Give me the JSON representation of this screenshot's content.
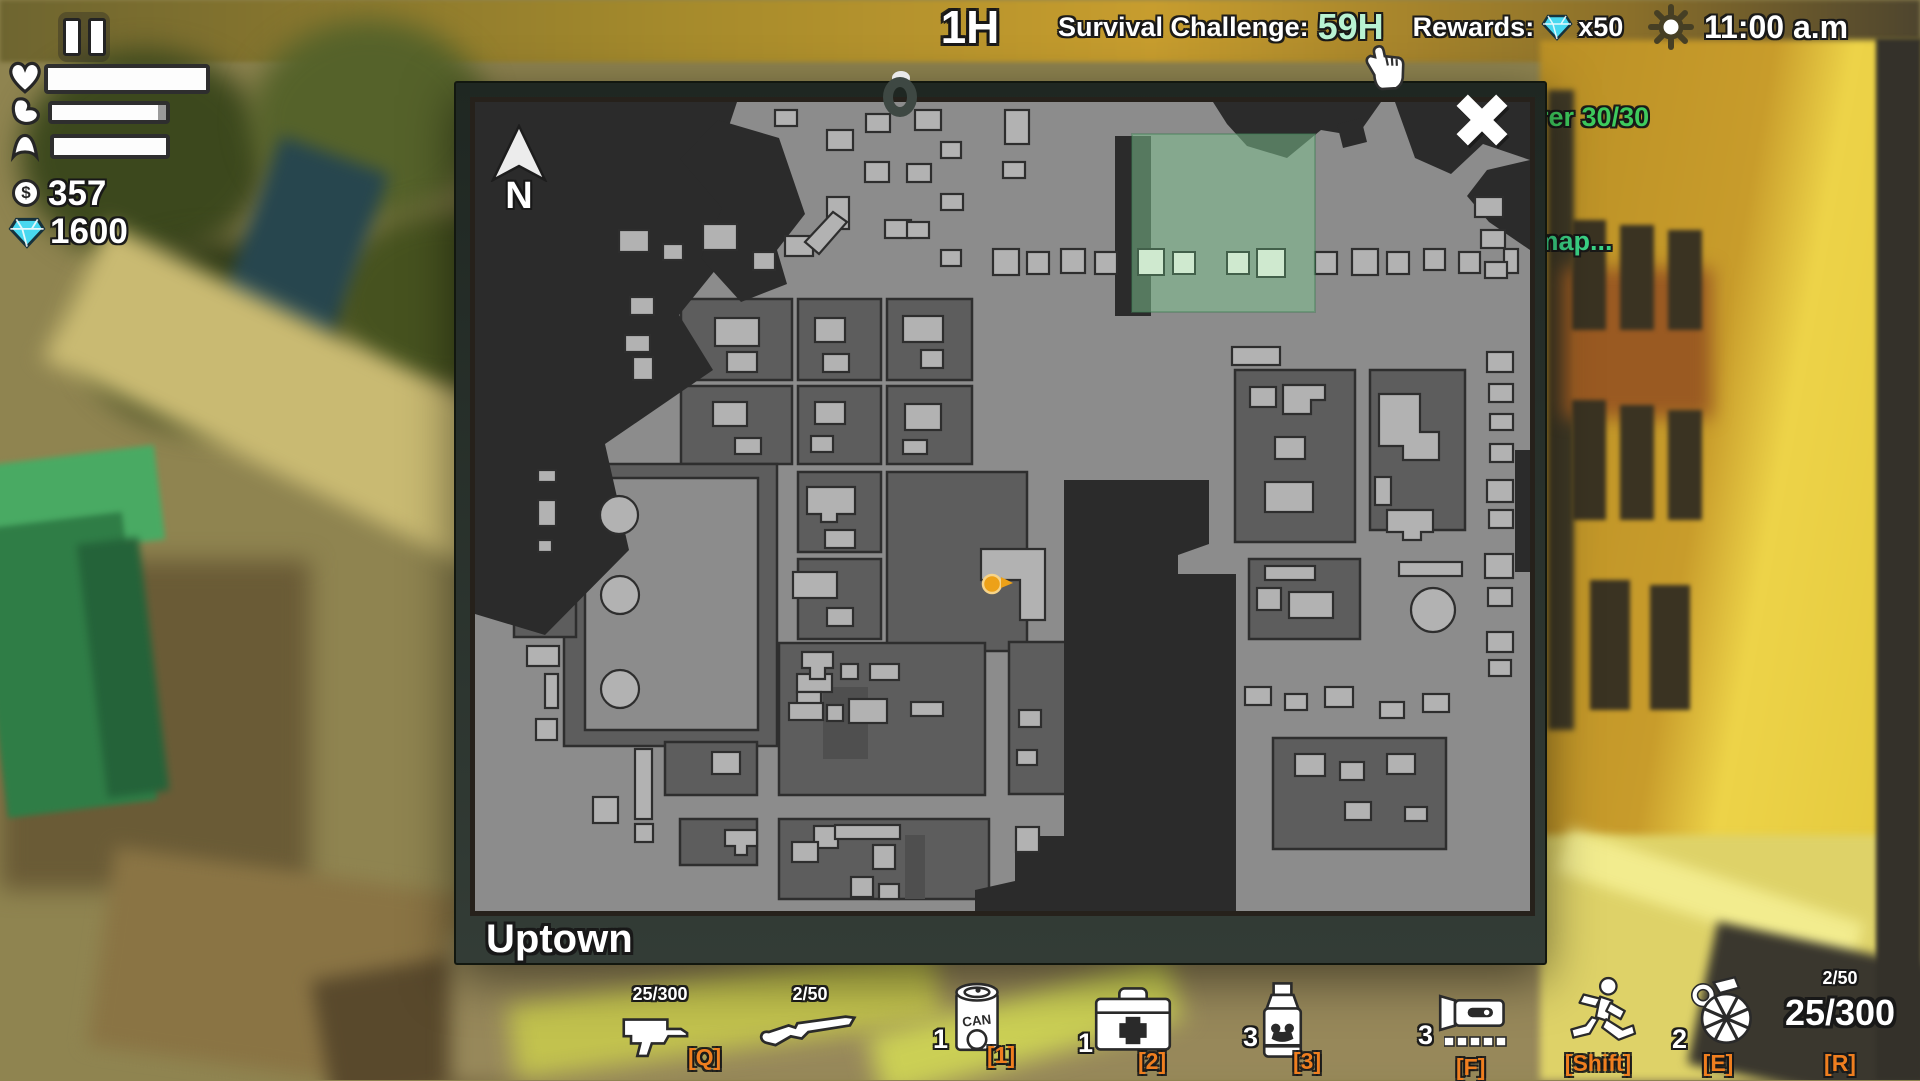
{
  "top": {
    "elapsed": "1H",
    "challenge_label": "Survival Challenge:",
    "challenge_value": "59H",
    "rewards_label": "Rewards:",
    "rewards_multiplier": "x50",
    "clock": "11:00 a.m",
    "challenge_value_color": "#b9f2d2",
    "gem_color": "#48d8f0"
  },
  "hud": {
    "money": "357",
    "gems": "1600",
    "bars": {
      "health_fill": 100,
      "hunger_fill": 93,
      "energy_fill": 100
    }
  },
  "messages": {
    "line1": "rer 30/30",
    "line2": "e map...",
    "color1": "#3ecb5d",
    "color2": "#3bd486"
  },
  "map": {
    "region": "Uptown",
    "compass": "N",
    "player": {
      "x": 517,
      "y": 482
    },
    "colors": {
      "street": "#8c8c8c",
      "block": "#5d5d5d",
      "dark": "#2b2b2b",
      "cutout": "#4f4f4f",
      "building": "#b2b2b2",
      "outline": "#2e2e2e",
      "zone": "#7ec28f",
      "zone_building": "#cfe9cf",
      "player": "#eda118"
    },
    "shapes": {
      "blocks": [
        [
          206,
          197,
          111,
          81
        ],
        [
          323,
          197,
          83,
          81
        ],
        [
          412,
          197,
          85,
          81
        ],
        [
          206,
          284,
          111,
          78
        ],
        [
          323,
          284,
          83,
          78
        ],
        [
          412,
          284,
          85,
          78
        ],
        [
          89,
          362,
          213,
          282
        ],
        [
          39,
          455,
          62,
          80
        ],
        [
          323,
          370,
          83,
          80
        ],
        [
          323,
          457,
          83,
          80
        ],
        [
          412,
          370,
          140,
          179
        ],
        [
          760,
          268,
          120,
          172
        ],
        [
          895,
          268,
          95,
          160
        ],
        [
          304,
          541,
          206,
          152
        ],
        [
          190,
          640,
          92,
          53
        ],
        [
          205,
          717,
          77,
          46
        ],
        [
          304,
          717,
          210,
          80
        ],
        [
          774,
          457,
          111,
          80
        ],
        [
          798,
          636,
          173,
          111
        ],
        [
          534,
          540,
          90,
          152
        ]
      ],
      "yards": [
        [
          110,
          376,
          173,
          252
        ]
      ],
      "dark": [
        "0,0 262,0 243,57 292,104 204,213 238,268 130,342 154,448 70,533 0,512",
        "205,57 243,18 304,36 330,112 302,148 312,182 266,200 226,156 247,106",
        "738,0 906,0 882,34 846,28 812,56 772,44 752,22",
        "920,0 1055,0 1055,58 1008,42 976,72 940,56",
        "1055,58 1055,148 1014,120 992,94 1012,68",
        "862,22 886,16 892,40 868,46",
        "589,378 734,378 734,442 703,453 703,472 761,472 761,810 500,810 500,788 540,779 540,734 589,734",
        "0,362 26,362 26,458 0,458",
        "640,34 676,34 676,214 640,214",
        "1040,348 1055,348 1055,470 1040,470"
      ],
      "cutouts": [
        [
          348,
          585,
          45,
          72
        ],
        [
          430,
          733,
          20,
          64
        ]
      ],
      "buildings": [
        [
          144,
          128,
          30,
          22
        ],
        [
          188,
          142,
          20,
          16
        ],
        [
          228,
          122,
          34,
          26
        ],
        [
          278,
          150,
          22,
          18
        ],
        [
          310,
          134,
          28,
          20
        ],
        [
          352,
          95,
          22,
          32
        ],
        [
          300,
          8,
          22,
          16
        ],
        [
          352,
          28,
          26,
          20
        ],
        [
          390,
          60,
          24,
          20
        ],
        [
          410,
          118,
          26,
          18
        ],
        [
          391,
          12,
          24,
          18
        ],
        [
          440,
          8,
          26,
          20
        ],
        [
          466,
          40,
          20,
          16
        ],
        [
          432,
          62,
          24,
          18
        ],
        [
          466,
          92,
          22,
          16
        ],
        [
          432,
          120,
          22,
          16
        ],
        [
          466,
          148,
          20,
          16
        ],
        [
          530,
          8,
          24,
          34
        ],
        [
          528,
          60,
          22,
          16
        ],
        [
          518,
          147,
          26,
          26
        ],
        [
          552,
          150,
          22,
          22
        ],
        [
          586,
          147,
          24,
          24
        ],
        [
          620,
          150,
          22,
          22
        ],
        [
          840,
          150,
          22,
          22
        ],
        [
          877,
          147,
          26,
          26
        ],
        [
          912,
          150,
          22,
          22
        ],
        [
          949,
          147,
          21,
          21
        ],
        [
          984,
          150,
          21,
          21
        ],
        [
          1029,
          147,
          14,
          24
        ],
        [
          1000,
          95,
          28,
          20
        ],
        [
          1006,
          128,
          24,
          18
        ],
        [
          1010,
          160,
          22,
          16
        ],
        [
          155,
          195,
          24,
          18
        ],
        [
          150,
          233,
          25,
          17
        ],
        [
          158,
          255,
          20,
          23
        ],
        [
          63,
          368,
          18,
          12
        ],
        [
          63,
          398,
          18,
          26
        ],
        [
          63,
          438,
          14,
          12
        ],
        [
          240,
          216,
          44,
          28
        ],
        [
          252,
          250,
          30,
          20
        ],
        [
          340,
          216,
          30,
          24
        ],
        [
          348,
          252,
          26,
          18
        ],
        [
          428,
          214,
          40,
          26
        ],
        [
          446,
          248,
          22,
          18
        ],
        [
          238,
          300,
          34,
          24
        ],
        [
          260,
          336,
          26,
          16
        ],
        [
          340,
          300,
          30,
          22
        ],
        [
          336,
          334,
          22,
          16
        ],
        [
          430,
          302,
          36,
          26
        ],
        [
          428,
          338,
          24,
          14
        ],
        [
          350,
          428,
          30,
          18
        ],
        [
          318,
          470,
          44,
          26
        ],
        [
          352,
          506,
          26,
          18
        ],
        [
          775,
          285,
          26,
          20
        ],
        [
          800,
          335,
          30,
          22
        ],
        [
          790,
          380,
          48,
          30
        ],
        [
          900,
          375,
          16,
          28
        ],
        [
          757,
          245,
          48,
          18
        ],
        [
          1012,
          250,
          26,
          20
        ],
        [
          1014,
          282,
          24,
          18
        ],
        [
          1015,
          312,
          23,
          16
        ],
        [
          1015,
          342,
          23,
          18
        ],
        [
          1012,
          378,
          26,
          22
        ],
        [
          1014,
          408,
          24,
          18
        ],
        [
          1010,
          452,
          28,
          24
        ],
        [
          1013,
          486,
          24,
          18
        ],
        [
          1012,
          530,
          26,
          20
        ],
        [
          1014,
          558,
          22,
          16
        ],
        [
          790,
          464,
          50,
          14
        ],
        [
          924,
          460,
          63,
          14
        ],
        [
          782,
          486,
          24,
          22
        ],
        [
          814,
          490,
          44,
          26
        ],
        [
          366,
          562,
          17,
          15
        ],
        [
          395,
          562,
          29,
          16
        ],
        [
          322,
          572,
          35,
          18
        ],
        [
          322,
          590,
          24,
          13
        ],
        [
          314,
          601,
          34,
          17
        ],
        [
          352,
          603,
          16,
          16
        ],
        [
          374,
          597,
          38,
          24
        ],
        [
          436,
          600,
          32,
          14
        ],
        [
          544,
          608,
          22,
          17
        ],
        [
          542,
          648,
          20,
          15
        ],
        [
          339,
          724,
          24,
          22
        ],
        [
          317,
          740,
          26,
          20
        ],
        [
          360,
          723,
          65,
          14
        ],
        [
          398,
          743,
          22,
          24
        ],
        [
          376,
          775,
          22,
          20
        ],
        [
          404,
          782,
          20,
          15
        ],
        [
          541,
          725,
          23,
          25
        ],
        [
          237,
          650,
          28,
          22
        ],
        [
          52,
          544,
          32,
          20
        ],
        [
          70,
          572,
          13,
          34
        ],
        [
          61,
          617,
          21,
          21
        ],
        [
          118,
          695,
          25,
          26
        ],
        [
          160,
          647,
          17,
          70
        ],
        [
          160,
          722,
          18,
          18
        ],
        [
          820,
          652,
          30,
          22
        ],
        [
          865,
          660,
          24,
          18
        ],
        [
          912,
          652,
          28,
          20
        ],
        [
          870,
          700,
          26,
          18
        ],
        [
          930,
          705,
          22,
          14
        ],
        [
          770,
          585,
          26,
          18
        ],
        [
          810,
          592,
          22,
          16
        ],
        [
          850,
          585,
          28,
          20
        ],
        [
          905,
          600,
          24,
          16
        ],
        [
          948,
          592,
          26,
          18
        ]
      ],
      "bpolys": [
        "330,140 358,110 372,120 344,152",
        "332,385 380,385 380,412 362,412 362,420 346,420 346,412 332,412",
        "506,447 570,447 570,518 545,518 545,478 506,478",
        "808,283 850,283 850,298 836,298 836,312 808,312",
        "904,292 945,292 945,330 964,330 964,358 928,358 928,344 904,344",
        "912,408 958,408 958,430 946,430 946,438 928,438 928,430 912,430",
        "327,550 358,550 358,566 350,566 350,577 335,577 335,566 327,566",
        "250,728 282,728 282,744 272,744 272,753 260,753 260,744 250,744"
      ],
      "circles": [
        [
          144,
          413,
          19
        ],
        [
          145,
          493,
          19
        ],
        [
          145,
          587,
          19
        ],
        [
          958,
          508,
          22
        ]
      ],
      "green_zone": [
        657,
        32,
        183,
        178
      ],
      "green_buildings": [
        [
          663,
          147,
          26,
          26
        ],
        [
          698,
          150,
          22,
          22
        ],
        [
          752,
          150,
          22,
          22
        ],
        [
          782,
          147,
          28,
          28
        ]
      ]
    }
  },
  "hotbar": {
    "key_color": "#ef7e1f",
    "items": [
      {
        "id": "smg",
        "ammo": "25/300",
        "key": "[Q]"
      },
      {
        "id": "shotgun",
        "ammo": "2/50",
        "key": ""
      },
      {
        "id": "canned-food",
        "count": "1",
        "key": "[1]",
        "label": "CAN"
      },
      {
        "id": "medkit",
        "count": "1",
        "key": "[2]"
      },
      {
        "id": "energy-drink",
        "count": "3",
        "key": "[3]"
      },
      {
        "id": "flashlight",
        "count": "3",
        "key": "[F]"
      },
      {
        "id": "sprint",
        "key": "[Shift]"
      },
      {
        "id": "grenade",
        "count": "2",
        "key": "[E]"
      },
      {
        "id": "ammo-counter",
        "reserve": "2/50",
        "current": "25/300",
        "key": "[R]"
      }
    ]
  }
}
